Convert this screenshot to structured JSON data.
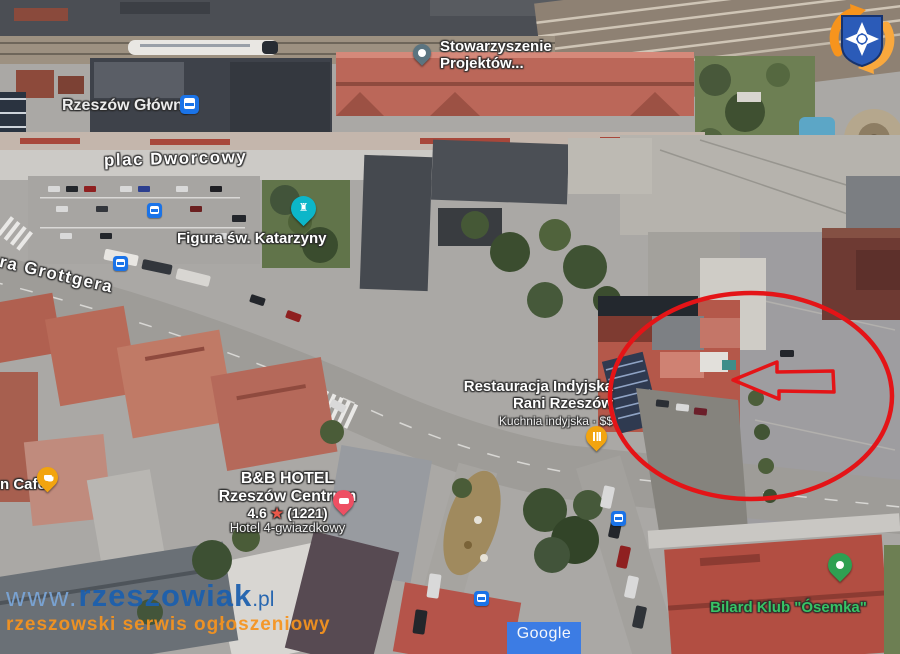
{
  "map_provider": {
    "logo_text": "Google"
  },
  "labels": {
    "station": {
      "text": "Rzeszów Główny",
      "icon": "train-transit-icon"
    },
    "street_dworcowy": {
      "text": "plac Dworcowy"
    },
    "street_grottgera": {
      "text": "ra Grottgera"
    },
    "association": {
      "line1": "Stowarzyszenie",
      "line2": "Projektów..."
    },
    "figura": {
      "text": "Figura św. Katarzyny"
    },
    "restaurant": {
      "line1": "Restauracja Indyjska",
      "line2": "Rani Rzeszów",
      "subtitle": "Kuchnia indyjska · $$"
    },
    "hotel": {
      "line1": "B&B HOTEL",
      "line2": "Rzeszów Centrum",
      "rating": "4.6",
      "star": "★",
      "reviews": "(1221)",
      "category": "Hotel 4-gwiazdkowy"
    },
    "cafe": {
      "text": "n Café"
    },
    "billiard": {
      "text": "Bilard Klub \"Ósemka\"",
      "color": "#37c465"
    }
  },
  "markers": {
    "association_pin": {
      "color": "#5b7480",
      "icon": "map-pin"
    },
    "figura_pin": {
      "color": "#0cb6c9",
      "icon": "monument"
    },
    "restaurant_pin": {
      "color": "#f2a40f",
      "icon": "fork-knife"
    },
    "hotel_pin": {
      "color": "#ee4f63",
      "icon": "bed"
    },
    "cafe_pin": {
      "color": "#f2a40f",
      "icon": "coffee-cup"
    },
    "billiard_pin": {
      "color": "#2ea052",
      "icon": "dot"
    },
    "transit_color": "#1a73e8",
    "transit_count": 5
  },
  "annotations": {
    "highlight_circle": {
      "color": "#e41417",
      "shape": "ellipse"
    },
    "arrow": {
      "color": "#e41417",
      "direction": "left"
    }
  },
  "watermark": {
    "prefix": "www.",
    "name": "rzeszowiak",
    "tld": ".pl",
    "tagline": "rzeszowski serwis ogłoszeniowy",
    "blue": "#1b5fae",
    "orange": "#f7941e"
  },
  "site_logo": {
    "description": "blue shield with white maltese cross and orange swoosh"
  }
}
